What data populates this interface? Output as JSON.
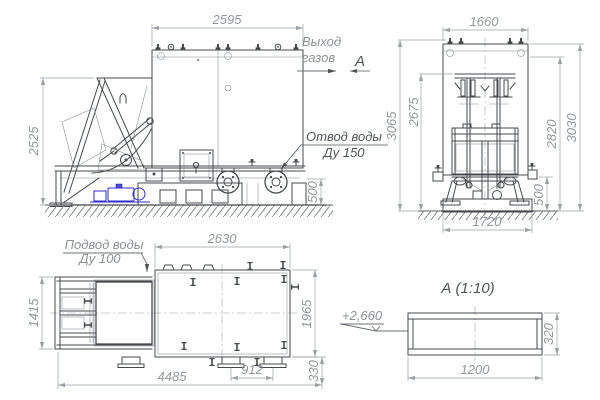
{
  "front_view": {
    "dim_width": "2595",
    "dim_height": "2525",
    "dim_drain_height": "500",
    "gas_outlet_label_line1": "Выход",
    "gas_outlet_label_line2": "газов",
    "section_cut_label": "А",
    "drain_label_line1": "Отвод воды",
    "drain_label_line2": "Ду 150"
  },
  "side_view": {
    "dim_width": "1660",
    "dim_height_outer_left": "3065",
    "dim_height_inner_left": "2675",
    "dim_height_inner_right": "2820",
    "dim_height_outer_right": "3030",
    "dim_stub_height": "500",
    "dim_foundation_width": "1720"
  },
  "plan_view": {
    "dim_tank_width": "2630",
    "dim_skip_depth": "1415",
    "dim_tank_depth": "1965",
    "dim_total_length": "4485",
    "dim_pad_spacing": "912",
    "dim_right_offset": "330",
    "supply_label_line1": "Подвод воды",
    "supply_label_line2": "Ду 100"
  },
  "section_view": {
    "title": "А  (1:10)",
    "elevation_mark": "+2,660",
    "dim_width": "1200",
    "dim_height": "320"
  },
  "colors": {
    "main_line": "#45494d",
    "dimension": "#9aa1a5",
    "annotation_gray": "#8b9195",
    "annotation_dark": "#4e5458",
    "accent_blue": "#2e2ed0",
    "background": "#ffffff"
  }
}
